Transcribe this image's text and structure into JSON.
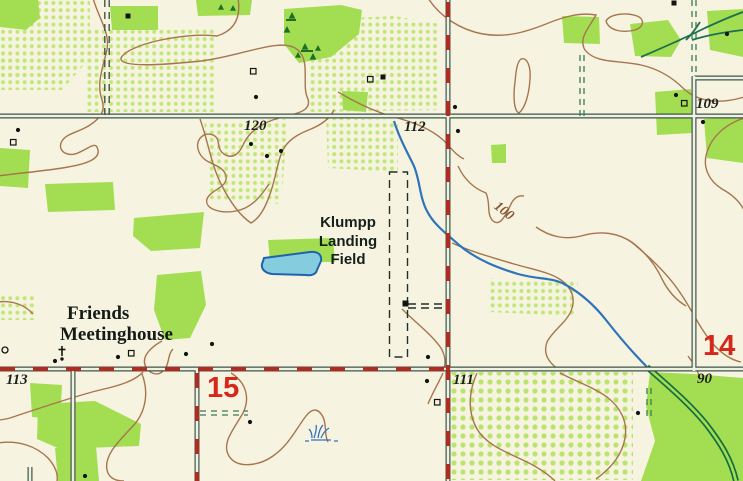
{
  "labels": {
    "landing_field": [
      "Klumpp",
      "Landing",
      "Field"
    ],
    "meetinghouse": [
      "Friends",
      "Meetinghouse"
    ]
  },
  "section_numbers": {
    "s15": "15",
    "s14": "14"
  },
  "elevations": {
    "e120": "120",
    "e112": "112",
    "e109": "109",
    "e113": "113",
    "e111": "111",
    "e90": "90"
  },
  "contour_labels": {
    "c100": "100"
  },
  "colors": {
    "background": "#f7f3e1",
    "woodland_green": "#a3de52",
    "orchard_dot_green": "#bfe878",
    "contour_brown": "#a5764e",
    "stream_blue": "#2f74b9",
    "pond_fill": "#85ccdf",
    "road_edge": "#3f544b",
    "boundary_red": "#ad2d22",
    "section_red": "#d5281b",
    "tree_dark_green": "#1f6e25",
    "channel_green": "#156e41"
  },
  "icons": {
    "building_filled": "filled-square",
    "building_open": "open-square",
    "church": "cross-symbol",
    "marsh": "marsh-tuft",
    "well": "small-circle"
  }
}
